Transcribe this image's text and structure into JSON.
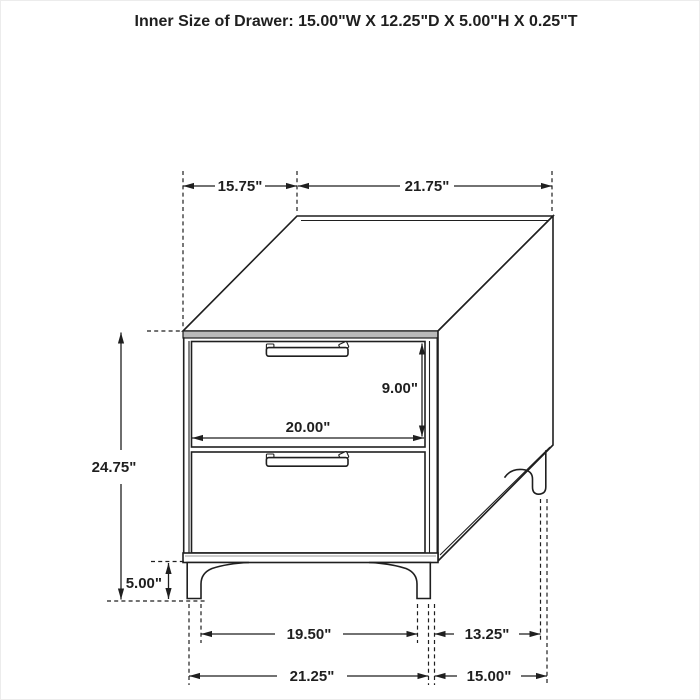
{
  "title": "Inner Size of Drawer: 15.00\"W X 12.25\"D X 5.00\"H X 0.25\"T",
  "colors": {
    "ink": "#1f1f1f",
    "background": "#ffffff",
    "top_edge_shade": "#b9b9b9"
  },
  "dimensions": {
    "top_depth": "15.75\"",
    "top_width": "21.75\"",
    "overall_height": "24.75\"",
    "drawer_opening_height": "9.00\"",
    "drawer_front_width": "20.00\"",
    "leg_height": "5.00\"",
    "front_leg_inner_span": "19.50\"",
    "side_leg_span": "13.25\"",
    "front_leg_outer_span": "21.25\"",
    "side_outer_span": "15.00\""
  }
}
